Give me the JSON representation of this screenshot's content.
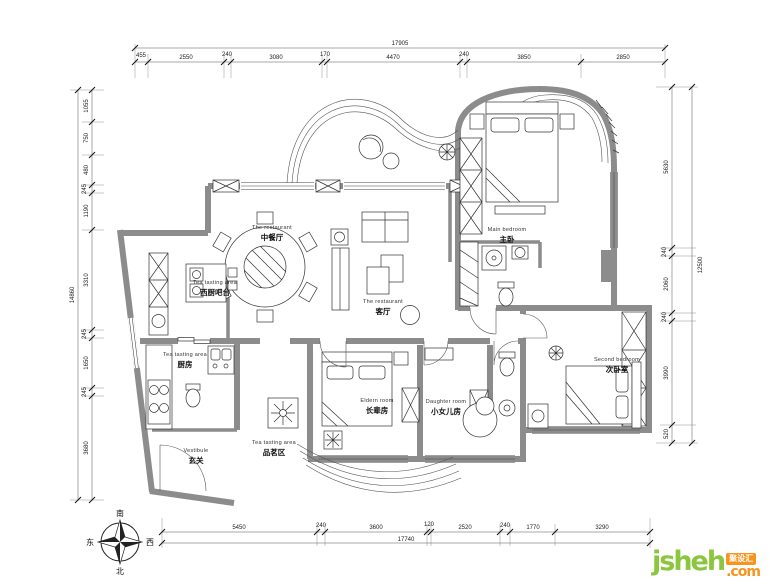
{
  "rooms": [
    {
      "en": "The restaurant",
      "zh": "中餐厅"
    },
    {
      "en": "The restaurant",
      "zh": "客厅"
    },
    {
      "en": "Main bedroom",
      "zh": "主卧"
    },
    {
      "en": "Tea tasting area",
      "zh": "西厨吧台"
    },
    {
      "en": "Tea tasting area",
      "zh": "厨房"
    },
    {
      "en": "Tea tasting area",
      "zh": "品茗区"
    },
    {
      "en": "Vestibule",
      "zh": "玄关"
    },
    {
      "en": "Eldern room",
      "zh": "长辈房"
    },
    {
      "en": "Daughter room",
      "zh": "小女儿房"
    },
    {
      "en": "Second bedroom",
      "zh": "次卧室"
    }
  ],
  "dims": {
    "top": {
      "total": "17905",
      "segs": [
        "455",
        "2550",
        "240",
        "3080",
        "170",
        "4470",
        "240",
        "3850",
        "2850"
      ]
    },
    "left": {
      "total": "14860",
      "segs": [
        "1055",
        "750",
        "480",
        "245",
        "1190",
        "3310",
        "245",
        "1650",
        "245",
        "3680"
      ]
    },
    "right": {
      "total": "12500",
      "segs": [
        "5630",
        "240",
        "2060",
        "240",
        "3990",
        "520"
      ]
    },
    "bottom": {
      "total": "17740",
      "segs": [
        "5450",
        "240",
        "3600",
        "120",
        "2520",
        "240",
        "1770",
        "3290"
      ]
    }
  },
  "compass": {
    "south": "南",
    "north": "北",
    "east": "东",
    "west": "西"
  },
  "logo": {
    "word": "jsheh",
    "badge": "聚设汇",
    "tld": ".com"
  },
  "colors": {
    "wall": "#8c8c8c",
    "line": "#333333",
    "logo_green": "#8bc63e",
    "logo_orange": "#f7941e"
  }
}
